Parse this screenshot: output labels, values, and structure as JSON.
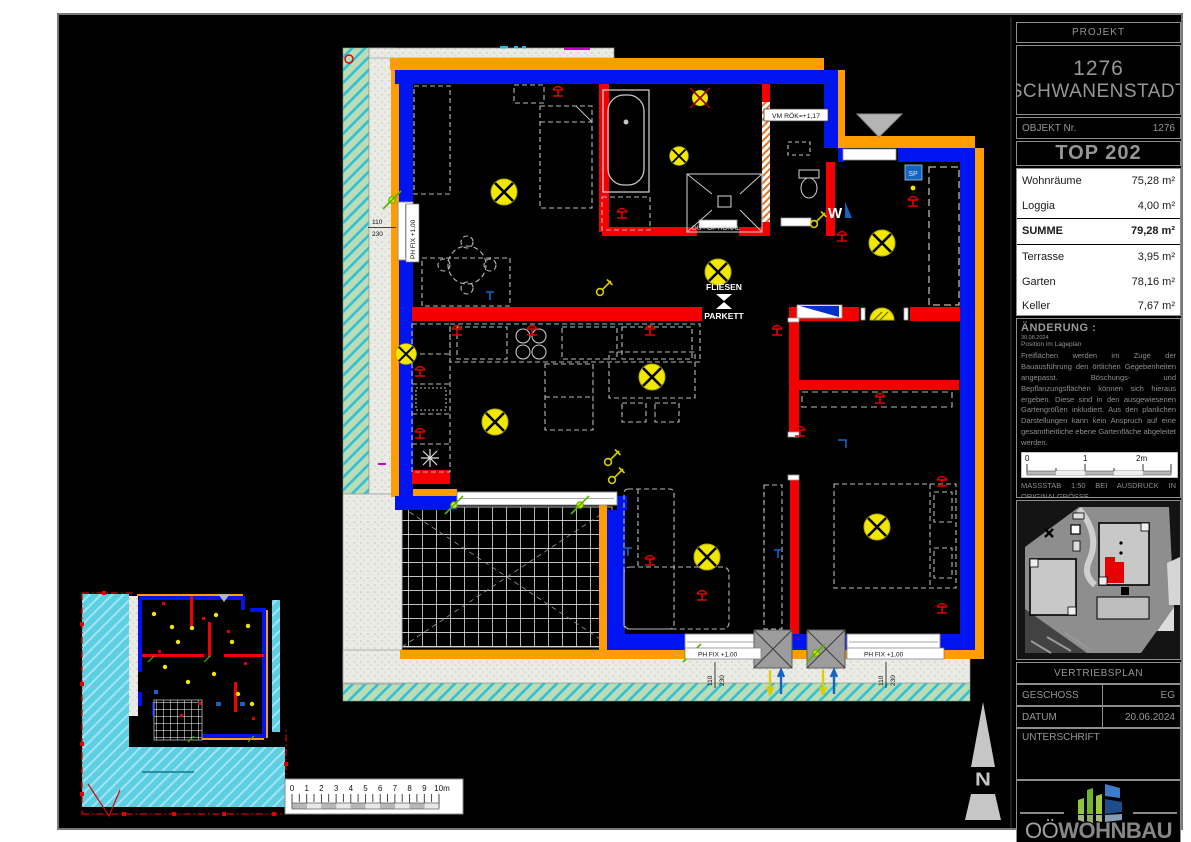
{
  "colors": {
    "wall_blue": "#0014f0",
    "wall_red": "#f40000",
    "insulation_orange": "#ff9c00",
    "lamp_yellow": "#f0e800",
    "garden_hatch_green": "#bcdcb6",
    "garden_hatch_line": "#2fc0d8",
    "mini_garden_cyan": "#5ecfe2",
    "highlight_red": "#e60000",
    "titleblock_gray": "#969696"
  },
  "plan": {
    "labels": {
      "vmrok": "VM RÖK=+1,17",
      "du_optional": "DU - OPTIONAL",
      "fliesen": "FLIESEN",
      "parkett": "PARKETT",
      "ph_fix": "PH FIX +1,00",
      "sp": "SP",
      "w": "W",
      "dim_110": "110",
      "dim_230": "230"
    }
  },
  "main_scalebar": {
    "ticks": [
      "0",
      "1",
      "2",
      "3",
      "4",
      "5",
      "6",
      "7",
      "8",
      "9",
      "10m"
    ]
  },
  "north": {
    "label": "N"
  },
  "title_block": {
    "projekt_label": "PROJEKT",
    "project_number": "1276",
    "project_city": "SCHWANENSTADT",
    "objekt_label": "OBJEKT Nr.",
    "objekt_value": "1276",
    "top_label": "TOP 202",
    "areas": {
      "rows": [
        {
          "label": "Wohnräume",
          "value": "75,28 m²"
        },
        {
          "label": "Loggia",
          "value": "4,00 m²"
        }
      ],
      "sum": {
        "label": "SUMME",
        "value": "79,28 m²"
      },
      "extra": [
        {
          "label": "Terrasse",
          "value": "3,95 m²"
        },
        {
          "label": "Garten",
          "value": "78,16 m²"
        },
        {
          "label": "Keller",
          "value": "7,67 m²"
        }
      ]
    },
    "aenderung": {
      "heading": "ÄNDERUNG :",
      "date": "30.08.2024",
      "subline": "Position im Lageplan",
      "body": "Freiflächen werden im Zuge der Bauausführung den örtlichen Gegebenheiten angepasst. Böschungs- und Bepflanzungsflächen können sich hieraus ergeben. Diese sind in den ausgewiesenen Gartengrößen inkludiert. Aus den planlichen Darstellungen kann kein Anspruch auf eine gesamtheitliche ebene Gartenfläche abgeleitet werden."
    },
    "mini_scalebar": {
      "t0": "0",
      "t1": "1",
      "t2": "2m"
    },
    "massstab": "MASSSTAB 1:50 BEI AUSDRUCK IN ORIGINALGRÖSSE",
    "raumhoehe": "RAUMHÖHE=2,58m",
    "deckenhoehe": "HÖHE BEI ABGEHÄNGTER DECKE MIND. 2,10m",
    "vertriebsplan_label": "VERTRIEBSPLAN",
    "geschoss_label": "GESCHOSS",
    "geschoss_value": "EG",
    "datum_label": "DATUM",
    "datum_value": "20.06.2024",
    "unterschrift_label": "UNTERSCHRIFT",
    "logo_prefix": "OÖ",
    "logo_main": "WOHNBAU"
  }
}
